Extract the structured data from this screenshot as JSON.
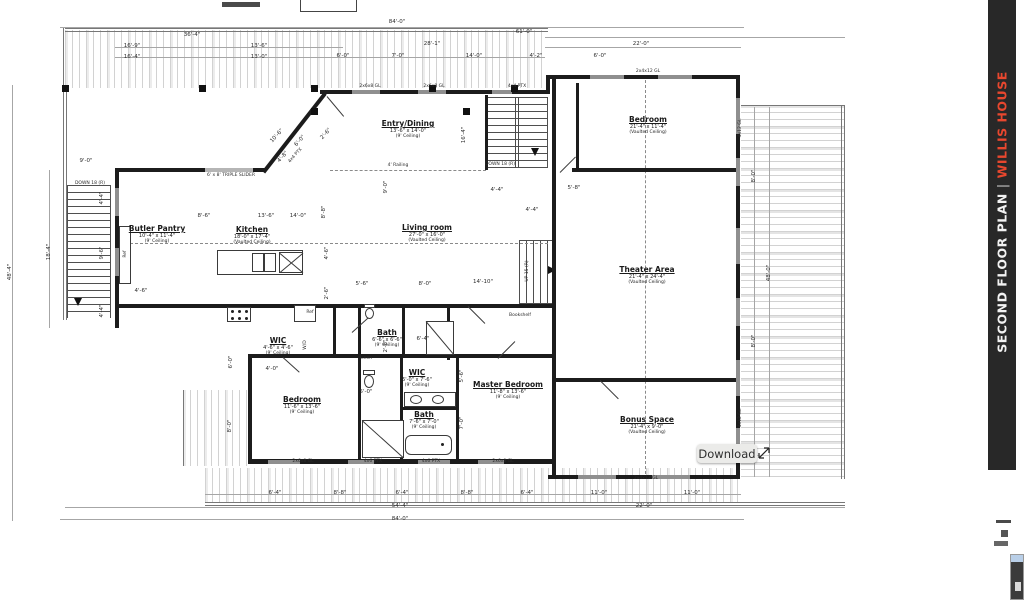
{
  "sidebar": {
    "sheet": "SECOND FLOOR PLAN",
    "divider": "|",
    "project": "WILLIS HOUSE",
    "bg": "#282828",
    "accent": "#e8472e"
  },
  "tooltip": {
    "label": "Download"
  },
  "rooms": [
    {
      "name": "Entry/Dining",
      "size": "13'-6\" x 14'-0\"",
      "ceiling": "(9' Ceiling)",
      "x": 408,
      "y": 120
    },
    {
      "name": "Bedroom",
      "size": "21'-4\" x 11'-4\"",
      "ceiling": "(Vaulted Ceiling)",
      "x": 648,
      "y": 116
    },
    {
      "name": "Butler Pantry",
      "size": "10'-4\" x 11'-4\"",
      "ceiling": "(9' Ceiling)",
      "x": 157,
      "y": 225
    },
    {
      "name": "Kitchen",
      "size": "18'-0\" x 17'-4\"",
      "ceiling": "(Vaulted Ceiling)",
      "x": 252,
      "y": 226
    },
    {
      "name": "Living room",
      "size": "27'-0\" x 16'-0\"",
      "ceiling": "(Vaulted Ceiling)",
      "x": 427,
      "y": 224
    },
    {
      "name": "Theater Area",
      "size": "21'-4\" x 24'-4\"",
      "ceiling": "(Vaulted Ceiling)",
      "x": 647,
      "y": 266
    },
    {
      "name": "Bedroom",
      "size": "11'-6\" x 13'-6\"",
      "ceiling": "(9' Ceiling)",
      "x": 302,
      "y": 396
    },
    {
      "name": "Master Bedroom",
      "size": "11'-8\" x 13'-6\"",
      "ceiling": "(9' Ceiling)",
      "x": 508,
      "y": 381
    },
    {
      "name": "Bonus Space",
      "size": "21'-4\" x 9'-0\"",
      "ceiling": "(Vaulted Ceiling)",
      "x": 647,
      "y": 416
    },
    {
      "name": "Bath",
      "size": "6'-6\" x 6'-6\"",
      "ceiling": "(9' Ceiling)",
      "x": 387,
      "y": 329
    },
    {
      "name": "WIC",
      "size": "4'-6\" x 4'-6\"",
      "ceiling": "(9' Ceiling)",
      "x": 278,
      "y": 337
    },
    {
      "name": "WIC",
      "size": "5'-0\" x 7'-6\"",
      "ceiling": "(9' Ceiling)",
      "x": 417,
      "y": 369
    },
    {
      "name": "Bath",
      "size": "7'-6\" x 7'-0\"",
      "ceiling": "(9' Ceiling)",
      "x": 424,
      "y": 411
    }
  ],
  "labels": [
    {
      "t": "84'-0\"",
      "x": 397,
      "y": 22
    },
    {
      "t": "61'-0\"",
      "x": 524,
      "y": 32
    },
    {
      "t": "28'-1\"",
      "x": 432,
      "y": 44
    },
    {
      "t": "22'-0\"",
      "x": 641,
      "y": 44
    },
    {
      "t": "36'-4\"",
      "x": 192,
      "y": 35
    },
    {
      "t": "16'-9\"",
      "x": 132,
      "y": 46
    },
    {
      "t": "16'-4\"",
      "x": 132,
      "y": 57
    },
    {
      "t": "13'-6\"",
      "x": 259,
      "y": 46
    },
    {
      "t": "13'-0\"",
      "x": 259,
      "y": 57
    },
    {
      "t": "6'-0\"",
      "x": 343,
      "y": 56
    },
    {
      "t": "7'-0\"",
      "x": 398,
      "y": 56
    },
    {
      "t": "14'-0\"",
      "x": 474,
      "y": 56
    },
    {
      "t": "4'-2\"",
      "x": 536,
      "y": 56
    },
    {
      "t": "6'-0\"",
      "x": 600,
      "y": 56
    },
    {
      "t": "2x6x8 GL",
      "x": 370,
      "y": 87,
      "s": "xs"
    },
    {
      "t": "2x6x8 GL",
      "x": 434,
      "y": 87,
      "s": "xs"
    },
    {
      "t": "4x4 PTX",
      "x": 517,
      "y": 87,
      "s": "xs"
    },
    {
      "t": "2x4x12 GL",
      "x": 648,
      "y": 72,
      "s": "xs"
    },
    {
      "t": "48'-4\"",
      "x": 10,
      "y": 272,
      "r": -90
    },
    {
      "t": "18'-4\"",
      "x": 49,
      "y": 252,
      "r": -90
    },
    {
      "t": "9'-0\"",
      "x": 86,
      "y": 161
    },
    {
      "t": "DOWN 18 (R)",
      "x": 90,
      "y": 184,
      "s": "xs"
    },
    {
      "t": "4'-4\"",
      "x": 102,
      "y": 198,
      "r": -90
    },
    {
      "t": "9'-6\"",
      "x": 102,
      "y": 253,
      "r": -90
    },
    {
      "t": "4'-4\"",
      "x": 102,
      "y": 311,
      "r": -90
    },
    {
      "t": "6' x 8' TRIPLE SLIDER",
      "x": 231,
      "y": 176,
      "s": "xs"
    },
    {
      "t": "4x4 PTX",
      "x": 296,
      "y": 156,
      "r": -48,
      "s": "xs"
    },
    {
      "t": "10'-6\"",
      "x": 277,
      "y": 136,
      "r": -48
    },
    {
      "t": "6'-0\"",
      "x": 300,
      "y": 141,
      "r": -48
    },
    {
      "t": "4'-8\"",
      "x": 283,
      "y": 157,
      "r": -48
    },
    {
      "t": "2'-6\"",
      "x": 326,
      "y": 134,
      "r": -48
    },
    {
      "t": "8'-8\"",
      "x": 324,
      "y": 212,
      "r": -90
    },
    {
      "t": "9'-0\"",
      "x": 386,
      "y": 187,
      "r": -90
    },
    {
      "t": "16'-4\"",
      "x": 464,
      "y": 135,
      "r": -90
    },
    {
      "t": "4' Railing",
      "x": 398,
      "y": 166,
      "s": "xs"
    },
    {
      "t": "DOWN 18 (R)",
      "x": 500,
      "y": 165,
      "s": "xs"
    },
    {
      "t": "4'-4\"",
      "x": 497,
      "y": 190
    },
    {
      "t": "5'-8\"",
      "x": 574,
      "y": 188
    },
    {
      "t": "8'-6\"",
      "x": 204,
      "y": 216
    },
    {
      "t": "13'-6\"",
      "x": 266,
      "y": 216
    },
    {
      "t": "14'-0\"",
      "x": 298,
      "y": 216
    },
    {
      "t": "Ref",
      "x": 126,
      "y": 254,
      "r": -90,
      "s": "xs"
    },
    {
      "t": "Ref",
      "x": 310,
      "y": 313,
      "s": "xs"
    },
    {
      "t": "4'-6\"",
      "x": 327,
      "y": 253,
      "r": -90
    },
    {
      "t": "2'-6\"",
      "x": 327,
      "y": 293,
      "r": -90
    },
    {
      "t": "4'-6\"",
      "x": 141,
      "y": 291
    },
    {
      "t": "5'-6\"",
      "x": 362,
      "y": 284
    },
    {
      "t": "8'-0\"",
      "x": 425,
      "y": 284
    },
    {
      "t": "14'-10\"",
      "x": 483,
      "y": 282
    },
    {
      "t": "4'-4\"",
      "x": 532,
      "y": 210
    },
    {
      "t": "UP 15 (R)",
      "x": 528,
      "y": 271,
      "r": -90,
      "s": "xs"
    },
    {
      "t": "Bookshelf",
      "x": 520,
      "y": 316,
      "s": "xs"
    },
    {
      "t": "Linen",
      "x": 366,
      "y": 359,
      "s": "xs"
    },
    {
      "t": "W/D",
      "x": 306,
      "y": 345,
      "r": -90,
      "s": "xs"
    },
    {
      "t": "4x12 GL",
      "x": 741,
      "y": 128,
      "r": -90,
      "s": "xs"
    },
    {
      "t": "4x12 GL",
      "x": 741,
      "y": 418,
      "r": -90,
      "s": "xs"
    },
    {
      "t": "8'-0\"",
      "x": 754,
      "y": 176,
      "r": -90
    },
    {
      "t": "48'-0\"",
      "x": 769,
      "y": 273,
      "r": -90
    },
    {
      "t": "8'-0\"",
      "x": 754,
      "y": 341,
      "r": -90
    },
    {
      "t": "6'-0\"",
      "x": 231,
      "y": 362,
      "r": -90
    },
    {
      "t": "8'-0\"",
      "x": 230,
      "y": 426,
      "r": -90
    },
    {
      "t": "4'-0\"",
      "x": 272,
      "y": 369
    },
    {
      "t": "2'-8\"",
      "x": 386,
      "y": 346,
      "r": -90
    },
    {
      "t": "5'-0\"",
      "x": 366,
      "y": 392
    },
    {
      "t": "6'-4\"",
      "x": 423,
      "y": 339
    },
    {
      "t": "5'-6\"",
      "x": 462,
      "y": 376,
      "r": -90
    },
    {
      "t": "7'-0\"",
      "x": 462,
      "y": 423,
      "r": -90
    },
    {
      "t": "6'-4\"",
      "x": 275,
      "y": 493
    },
    {
      "t": "8'-8\"",
      "x": 340,
      "y": 493
    },
    {
      "t": "6'-4\"",
      "x": 402,
      "y": 493
    },
    {
      "t": "8'-8\"",
      "x": 467,
      "y": 493
    },
    {
      "t": "6'-4\"",
      "x": 527,
      "y": 493
    },
    {
      "t": "54'-4\"",
      "x": 400,
      "y": 506
    },
    {
      "t": "84'-0\"",
      "x": 400,
      "y": 519
    },
    {
      "t": "11'-0\"",
      "x": 599,
      "y": 493
    },
    {
      "t": "11'-0\"",
      "x": 692,
      "y": 493
    },
    {
      "t": "22'-0\"",
      "x": 644,
      "y": 506
    },
    {
      "t": "2x6x8 GL",
      "x": 303,
      "y": 462,
      "s": "xs"
    },
    {
      "t": "4x6 PTX",
      "x": 373,
      "y": 462,
      "s": "xs"
    },
    {
      "t": "4x6 PTX",
      "x": 431,
      "y": 462,
      "s": "xs"
    },
    {
      "t": "2x6x8 GL",
      "x": 503,
      "y": 462,
      "s": "xs"
    },
    {
      "t": "2x4x12 GL",
      "x": 646,
      "y": 479,
      "s": "xs"
    }
  ]
}
